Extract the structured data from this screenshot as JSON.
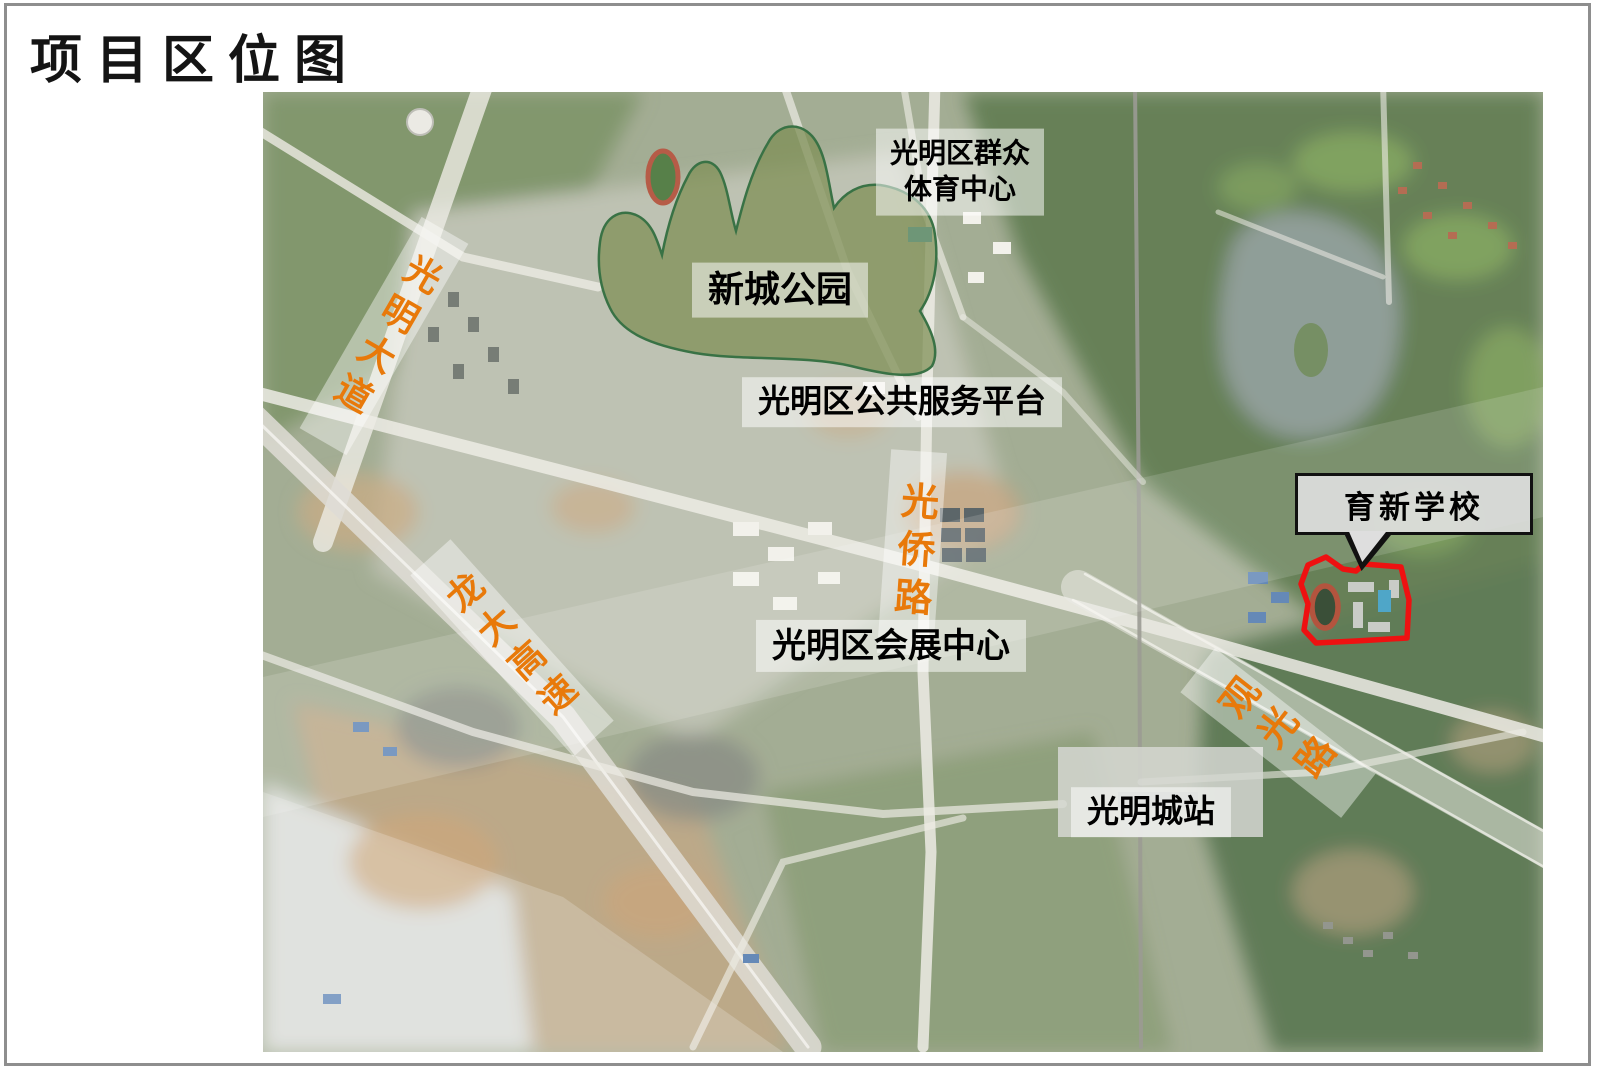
{
  "slide": {
    "title": "项目区位图"
  },
  "colors": {
    "accent-orange": "#E8790A",
    "outline-red": "#EE1111",
    "park-fill": "#76884A",
    "park-stroke": "#2F6B3C",
    "label-bg": "rgba(255,255,255,0.52)",
    "frame-gray": "#8E8E8E"
  },
  "map": {
    "kind": "satellite-location-map",
    "area_labels": {
      "sports_center": "光明区群众\n体育中心",
      "xincheng_park": "新城公园",
      "public_service_platform": "光明区公共服务平台",
      "convention_center": "光明区会展中心",
      "guangming_city_station": "光明城站"
    },
    "road_labels": {
      "guangming_avenue": "光明大道",
      "longda_expressway": "龙大高速",
      "guangqiao_road": "光侨路",
      "guanguang_road": "观光路"
    },
    "callout": {
      "school": "育新学校"
    }
  }
}
